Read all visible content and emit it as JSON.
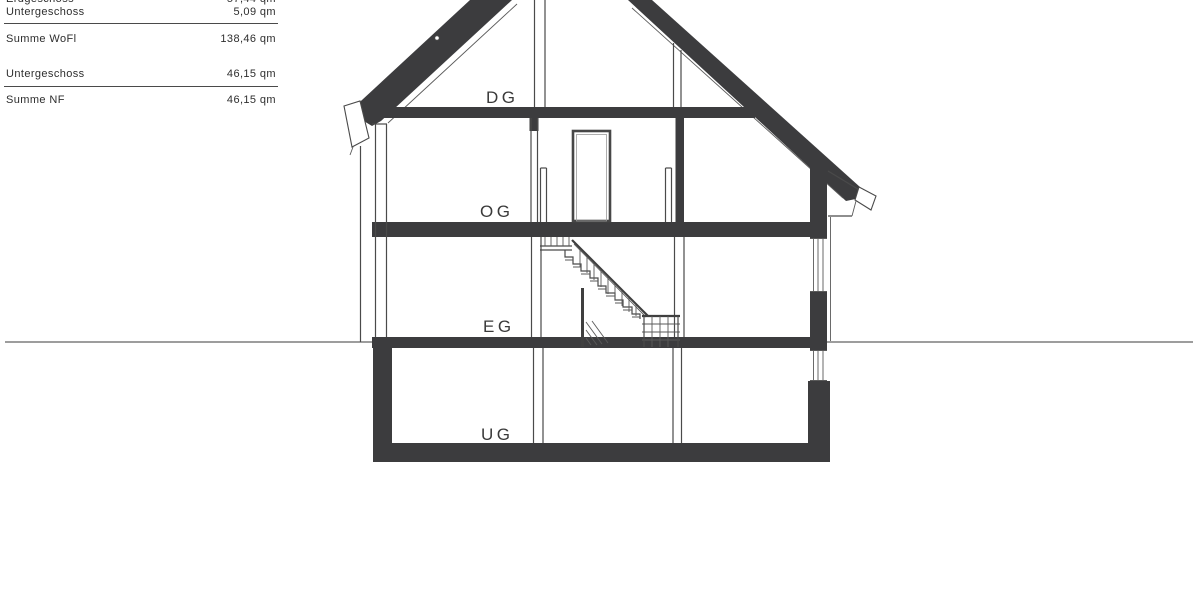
{
  "area_table": {
    "rows": [
      {
        "label": "Erdgeschoss",
        "value": "57,44 qm"
      },
      {
        "label": "Untergeschoss",
        "value": "5,09 qm"
      },
      {
        "label": "Summe WoFl",
        "value": "138,46 qm"
      },
      {
        "label": "Untergeschoss",
        "value": "46,15 qm"
      },
      {
        "label": "Summe NF",
        "value": "46,15 qm"
      }
    ]
  },
  "section": {
    "floor_labels": {
      "attic": "DG",
      "upper": "OG",
      "ground": "EG",
      "basement": "UG"
    }
  },
  "colors": {
    "poche": "#3c3c3e",
    "line": "#4a4a4a",
    "ground_line": "#7d7d7d",
    "text": "#2e2e2e"
  }
}
